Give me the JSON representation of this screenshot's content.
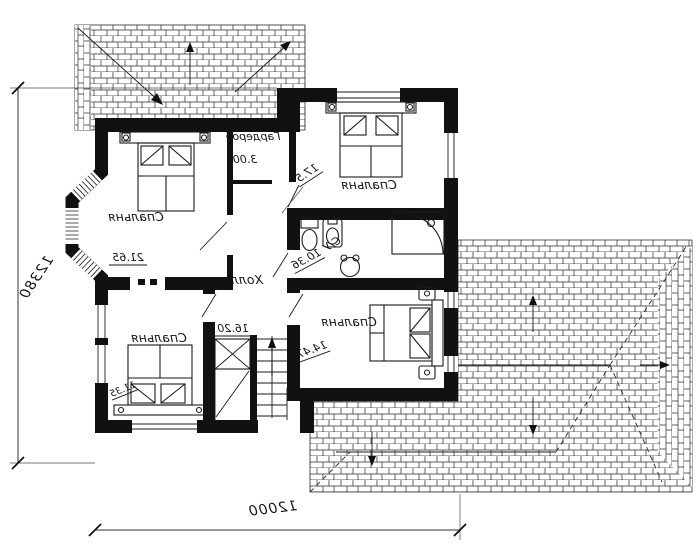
{
  "plan": {
    "type": "floor-plan-drawing-mirrored",
    "rooms": [
      {
        "label": "Спальня",
        "area": "21.65"
      },
      {
        "label": "Гардероб",
        "area": "3.00"
      },
      {
        "label": "Спальня",
        "area": "17.5"
      },
      {
        "label": "С/У",
        "area": "10.36"
      },
      {
        "label": "Холл",
        "area": "16.20"
      },
      {
        "label": "Спальня",
        "area": "14.47"
      },
      {
        "label": "Спальня",
        "area": "11.35"
      }
    ],
    "dimensions": {
      "left_total": "12380",
      "bottom_total": "12000"
    },
    "colors": {
      "ink": "#111111",
      "paper": "#ffffff"
    }
  }
}
